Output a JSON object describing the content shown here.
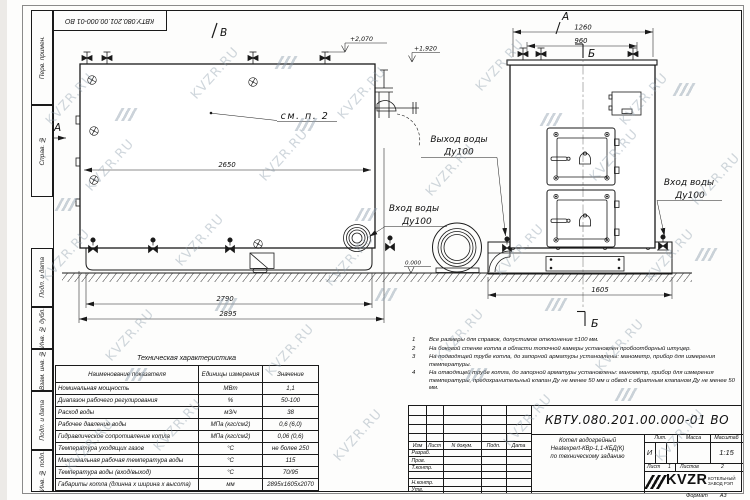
{
  "sheet": {
    "watermark": "KVZR.RU",
    "stamp_number": "КВТУ.080.201.00.000-01 ВО",
    "format_label": "Формат",
    "format_value": "А3"
  },
  "side_labels": {
    "items": [
      "Перв. примен.",
      "Справ. №",
      "Подп. и дата",
      "Инв. № дубл.",
      "Взам. инв. №",
      "Подп. и дата",
      "Инв. № подл."
    ]
  },
  "drawing": {
    "dims": {
      "length_inner": "2650",
      "length_base": "2790",
      "length_total": "2895",
      "width_top": "1260",
      "width_valves": "960",
      "width_base": "1605"
    },
    "elevations": {
      "top": "+2,070",
      "outlet": "+1,920",
      "zero": "0.000"
    },
    "markers": {
      "view_b": "В",
      "section_a_left": "А",
      "section_a_top": "А",
      "section_b_top": "Б",
      "section_b_bottom": "Б"
    },
    "labels": {
      "see_note": "см. п. 2",
      "water_out_1": "Выход воды",
      "water_out_2": "Ду100",
      "water_in_right_1": "Вход воды",
      "water_in_right_2": "Ду100",
      "water_in_left_1": "Вход воды",
      "water_in_left_2": "Ду100"
    }
  },
  "tech_table": {
    "title": "Техническая характеристика",
    "headers": [
      "Наименование показателя",
      "Единицы измерения",
      "Значение"
    ],
    "rows": [
      {
        "name": "Номинальная мощность",
        "unit": "МВт",
        "value": "1,1"
      },
      {
        "name": "Диапазон рабочего регулирования",
        "unit": "%",
        "value": "50-100"
      },
      {
        "name": "Расход воды",
        "unit": "м3/ч",
        "value": "38"
      },
      {
        "name": "Рабочее давление воды",
        "unit": "МПа (кгс/см2)",
        "value": "0,6 (6,0)"
      },
      {
        "name": "Гидравлическое сопротивление котла",
        "unit": "МПа (кгс/см2)",
        "value": "0,06 (0,6)"
      },
      {
        "name": "Температура уходящих газов",
        "unit": "°С",
        "value": "не более 250"
      },
      {
        "name": "Максимальная рабочая температура воды",
        "unit": "°С",
        "value": "115"
      },
      {
        "name": "Температура воды (вход/выход)",
        "unit": "°С",
        "value": "70/95"
      },
      {
        "name": "Габариты котла (длинна х ширина х высота)",
        "unit": "мм",
        "value": "2895х1605х2070"
      }
    ]
  },
  "notes": {
    "items": [
      {
        "num": "1",
        "text": "Все размеры для справок, допустимое отклонение ±100 мм."
      },
      {
        "num": "2",
        "text": "На боковой стенке котла в области топочной камеры установлен пробоотборный штуцер."
      },
      {
        "num": "3",
        "text": "На подводящей трубе котла, до запорной арматуры установлены: манометр, прибор для измерения температуры."
      },
      {
        "num": "4",
        "text": "На отводящей трубе котла, до запорной арматуры установлены: манометр, прибор для измерения температуры, предохранительный клапан Ду не менее 50 мм и обвод с обратным клапаном Ду не менее 50 мм."
      }
    ]
  },
  "title_block": {
    "doc_number": "КВТУ.080.201.00.000-01 ВО",
    "col_izm": "Изм",
    "col_list": "Лист",
    "col_doc": "N докум.",
    "col_sign": "Подп.",
    "col_date": "Дата",
    "row_razrab": "Разраб.",
    "row_prov": "Пров.",
    "row_tkontr": "Т.контр.",
    "row_nkontr": "Н.контр.",
    "row_utv": "Утв.",
    "name_line1": "Котел водогрейный",
    "name_line2": "Heatexpert-КВр-1,1-КБД(К)",
    "name_line3": "по техническому заданию",
    "lit_header": "Лит.",
    "mass_header": "Масса",
    "scale_header": "Масштаб",
    "lit_value": "И",
    "scale_value": "1:15",
    "sheet_label": "Лист",
    "sheet_value": "1",
    "sheets_label": "Листов",
    "sheets_value": "2",
    "logo_text": "KVZR",
    "company_line1": "КОТЕЛЬНЫЙ",
    "company_line2": "ЗАВОД РЭП"
  }
}
